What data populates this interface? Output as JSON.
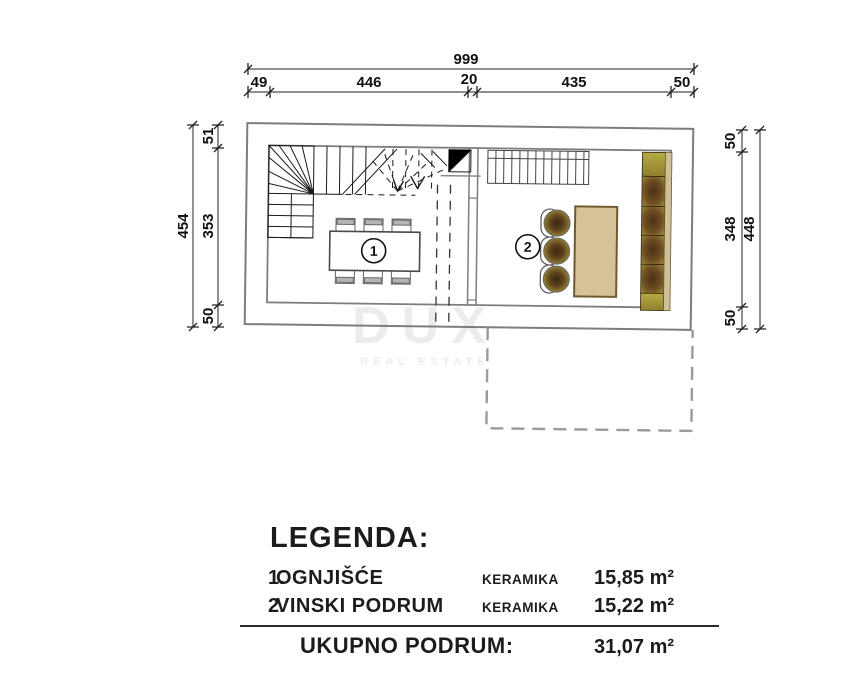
{
  "watermark": {
    "brand": "DUX",
    "tagline": "REAL ESTATE"
  },
  "plan": {
    "rooms": [
      {
        "number": "1"
      },
      {
        "number": "2"
      }
    ],
    "dimensions": {
      "top": {
        "total": "999",
        "segments": [
          "49",
          "446",
          "20",
          "435",
          "50"
        ]
      },
      "left": {
        "total": "454",
        "segments": [
          "51",
          "353",
          "50"
        ]
      },
      "right": {
        "total": "448",
        "segments": [
          "50",
          "348",
          "50"
        ]
      }
    }
  },
  "colors": {
    "wall_gray": "#7d7d7d",
    "table_tan": "#d6c199",
    "rack_side_tan": "#cfc09a",
    "rack_olive": "#a5933e",
    "rack_dark_brown": "#4a3118",
    "chair_gray": "#b5b5b5"
  },
  "legend": {
    "title": "LEGENDA:",
    "rows": [
      {
        "number": "1.",
        "name": "OGNJIŠĆE",
        "material": "KERAMIKA",
        "area": "15,85 m²"
      },
      {
        "number": "2.",
        "name": "VINSKI PODRUM",
        "material": "KERAMIKA",
        "area": "15,22 m²"
      }
    ],
    "total_label": "UKUPNO PODRUM:",
    "total_area": "31,07 m²"
  }
}
